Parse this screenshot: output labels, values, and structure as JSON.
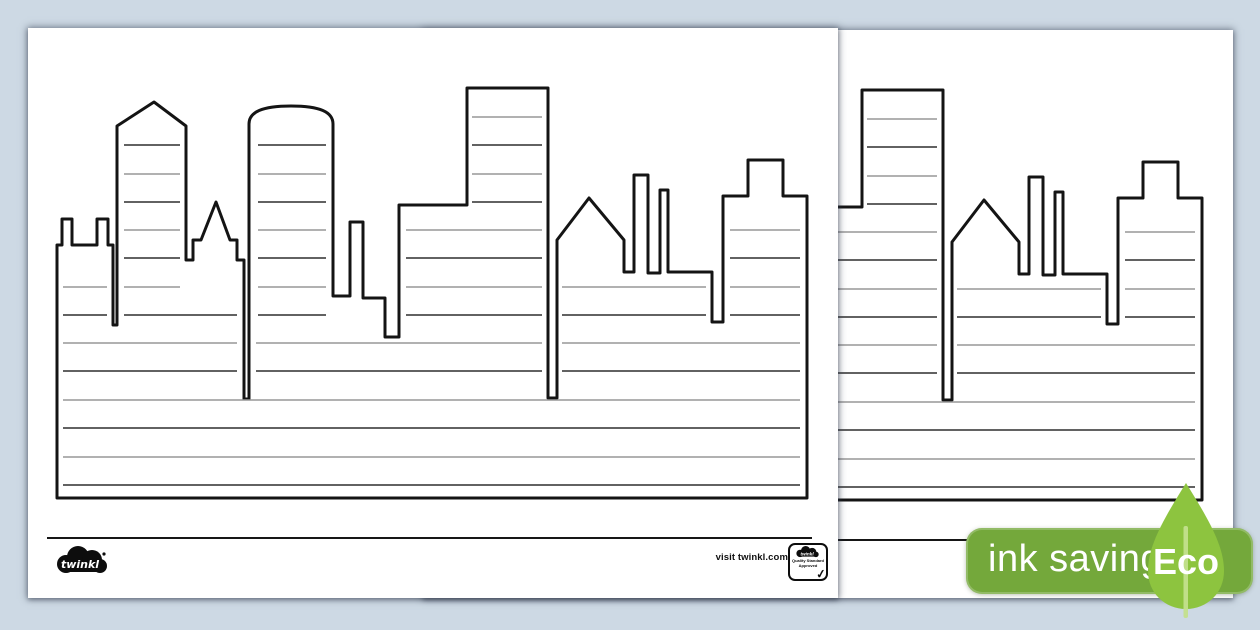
{
  "document": {
    "description_pages": [
      {
        "id": "front",
        "content": "city skyline writing frame with lined buildings"
      },
      {
        "id": "back",
        "content": "city skyline writing frame (partially hidden behind front page)"
      }
    ]
  },
  "footer": {
    "brand_logo_text": "twinkl",
    "visit_text": "visit twinkl.com",
    "quality_badge": {
      "logo_text": "twinkl",
      "line1": "Quality Standard",
      "line2": "Approved",
      "check_mark": "✓"
    }
  },
  "eco_badge": {
    "label": "ink saving",
    "leaf_label": "Eco",
    "pill_color": "#74a83b",
    "leaf_color": "#8dc43f",
    "stem_color": "#c3e08d",
    "text_color": "#ffffff"
  },
  "colors": {
    "background": "#cdd9e4",
    "page": "#ffffff",
    "skyline_outline": "#141414",
    "writing_line_light": "#979797",
    "writing_line_dark": "#2e2e2e"
  }
}
